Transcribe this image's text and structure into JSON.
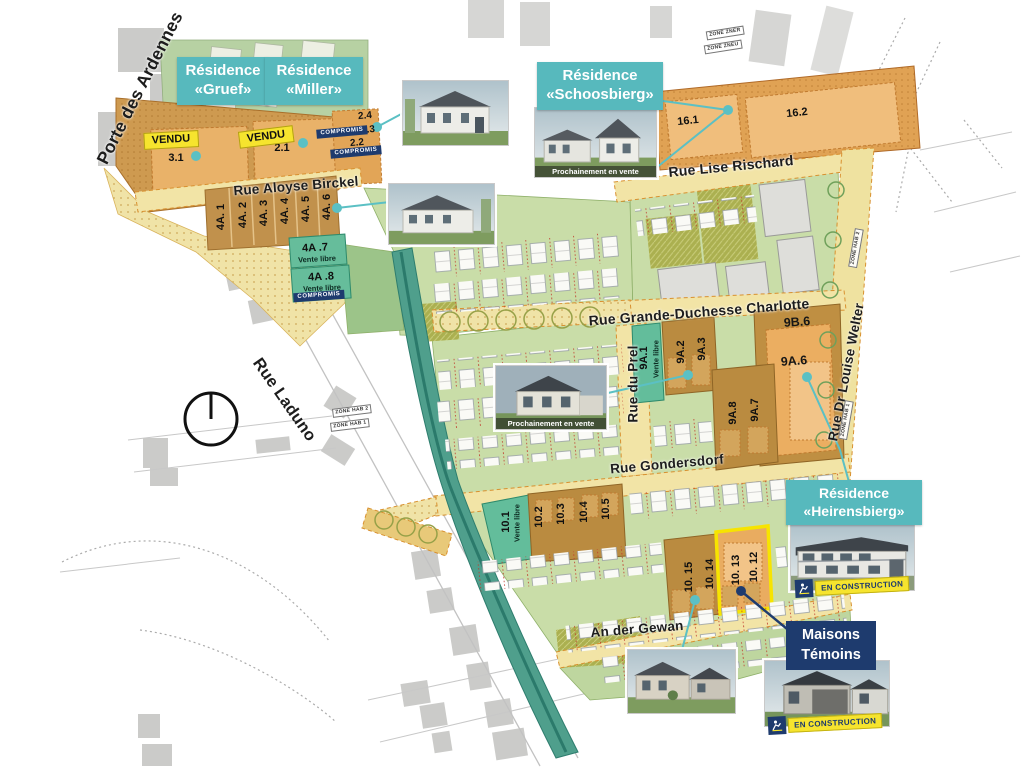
{
  "map": {
    "residences": {
      "gruef": {
        "l1": "Résidence",
        "l2": "«Gruef»"
      },
      "miller": {
        "l1": "Résidence",
        "l2": "«Miller»"
      },
      "schoosbierg": {
        "l1": "Résidence",
        "l2": "«Schoosbierg»"
      },
      "heirensbierg": {
        "l1": "Résidence",
        "l2": "«Heirensbierg»"
      }
    },
    "streets": {
      "porte_des_ardennes": "Porte des Ardennes",
      "aloyse_birckel": "Rue Aloyse Birckel",
      "lise_rischard": "Rue Lise Rischard",
      "gd_charlotte": "Rue Grande-Duchesse Charlotte",
      "du_prel": "Rue du Prel",
      "louise_welter": "Rue Dr Louise Welter",
      "gondersdorf": "Rue Gondersdorf",
      "laduno": "Rue Laduno",
      "an_der_gewan": "An der Gewan"
    },
    "lots": {
      "l3_1": "3.1",
      "l2_1": "2.1",
      "l2_2": "2.2",
      "l2_3": "2.3",
      "l2_4": "2.4",
      "l4a_1": "4A. 1",
      "l4a_2": "4A. 2",
      "l4a_3": "4A. 3",
      "l4a_4": "4A. 4",
      "l4a_5": "4A. 5",
      "l4a_6": "4A. 6",
      "l4a_7": "4A .7",
      "l4a_8": "4A .8",
      "l16_1": "16.1",
      "l16_2": "16.2",
      "l9a_1": "9A.1",
      "l9a_2": "9A.2",
      "l9a_3": "9A.3",
      "l9a_6": "9A.6",
      "l9a_7": "9A.7",
      "l9a_8": "9A.8",
      "l9b_6": "9B.6",
      "l10_1": "10.1",
      "l10_2": "10.2",
      "l10_3": "10.3",
      "l10_4": "10.4",
      "l10_5": "10.5",
      "l10_12": "10. 12",
      "l10_13": "10. 13",
      "l10_14": "10. 14",
      "l10_15": "10. 15"
    },
    "badges": {
      "vendu": "VENDU",
      "compromis": "COMPROMIS",
      "vente_libre": "Vente libre",
      "en_construction": "EN CONSTRUCTION",
      "prochainement": "Prochainement en vente",
      "maisons_l1": "Maisons",
      "maisons_l2": "Témoins"
    },
    "zones": {
      "zner": "ZONE ZNER",
      "zneu": "ZONE ZNEU",
      "hab2": "ZONE HAB 2",
      "hab1": "ZONE HAB 1"
    },
    "colors": {
      "teal_accent": "#57B9BD",
      "navy": "#1E3B6E",
      "vendu_yellow": "#F6E42E",
      "lot_brown": "#BA8B40",
      "lot_orange": "#E9AC60",
      "street_yellow": "#F2E4A6",
      "green_light": "#C9DDA8",
      "green_teal_lot": "#63BD9B",
      "canal_teal": "#4F9F8C",
      "highlight_yellow": "#F7E400"
    }
  }
}
